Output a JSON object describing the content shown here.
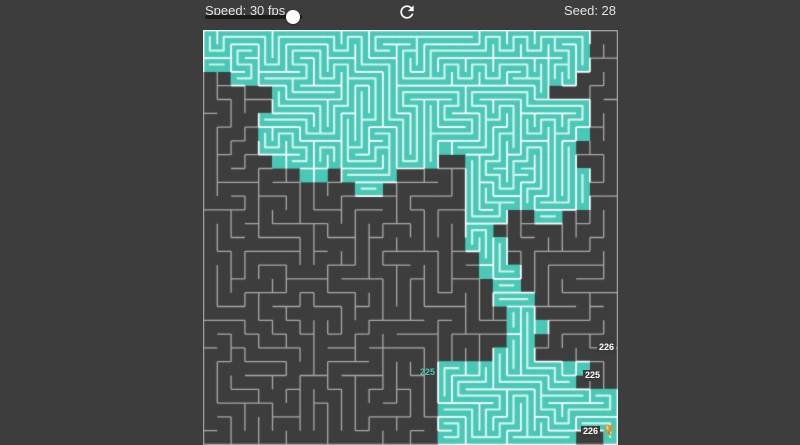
{
  "page": {
    "background": "#3D3D3D"
  },
  "toolbar": {
    "speed_label": "Speed: 30 fps",
    "speed_value_fps": 30,
    "seed_label": "Seed: 28"
  },
  "maze": {
    "cols": 30,
    "rows": 30,
    "cell_size": 13.8,
    "generation_seed": 28,
    "colors": {
      "visited_fill": "#4AC8B7",
      "visited_path": "#CEF2EB",
      "wall_on_visited": "#FFFFFF",
      "wall_on_dark": "#A9A9A9",
      "dark_fill": "#3D3D3D"
    },
    "visited_mask": [
      "111111111111111111111111111100",
      "111111111111111111111111111100",
      "111111111111111111111111111100",
      "001111111111111111111111111000",
      "000001111111111111111111100000",
      "000001111111111111111111111100",
      "000011111111111111111111111100",
      "000011111111111111111111111100",
      "000011111111111111111111111000",
      "000001111111111110011111111000",
      "000000011011110000011111111100",
      "000000000001100000011111111100",
      "000000000000000000011111111100",
      "000000000000000000011100110000",
      "000000000000000000011000000000",
      "000000000000000000011100000000",
      "000000000000000000001100000000",
      "000000000000000000001110000000",
      "000000000000000000000110000000",
      "000000000000000000000111000000",
      "000000000000000000000011000000",
      "000000000000000000000011100000",
      "000000000000000000000011000000",
      "000000000000000000000111000000",
      "000000000000000001111111111100",
      "000000000000000001111111111000",
      "000000000000000001111111111111",
      "000000000000000001111111111111",
      "000000000000000001111111111111",
      "000000000000000001111111111001"
    ],
    "counters": [
      {
        "text": "226",
        "variant": "box"
      },
      {
        "text": "225",
        "variant": "box"
      },
      {
        "text": "225",
        "variant": "plain"
      },
      {
        "text": "226",
        "variant": "box"
      }
    ],
    "goal_icon": "trophy-icon"
  }
}
